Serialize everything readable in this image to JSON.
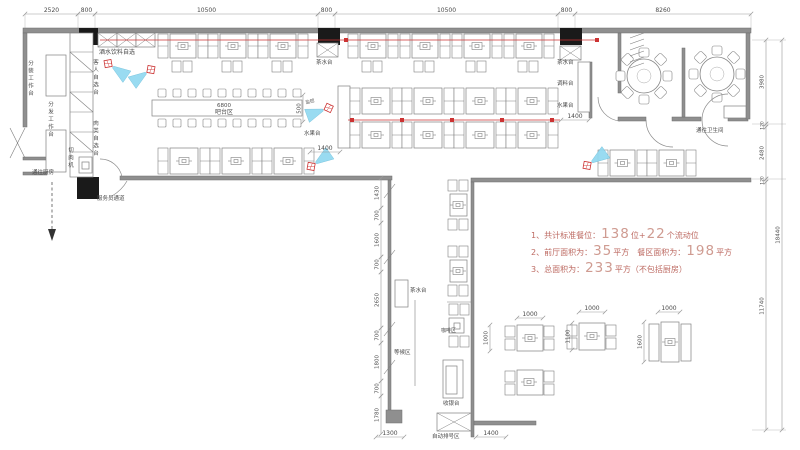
{
  "notes": {
    "line1": {
      "pre": "1、共计标准餐位：",
      "n1": "138",
      "mid": "位+",
      "n2": "22",
      "suf": "个流动位"
    },
    "line2": {
      "pre": "2、前厅面积为：",
      "n1": "35",
      "mid": "平方　餐区面积为：",
      "n2": "198",
      "suf": "平方"
    },
    "line3": {
      "pre": "3、总面积为：",
      "n1": "233",
      "suf": "平方（不包括厨房）"
    }
  },
  "plan": {
    "colors": {
      "wall": "#8f8f8f",
      "line": "#808080",
      "dim": "#999999",
      "dimtext": "#7a7a7a",
      "red": "#cc3333",
      "camera": "#8fd8f0",
      "black": "#1a1a1a"
    },
    "texts": [
      {
        "n": "label-drinks-self-service",
        "t": "酒水饮料自选",
        "x": 99,
        "y": 54,
        "s": 6
      },
      {
        "n": "label-packing-station",
        "t": "分装工作台",
        "x": 30,
        "y": 60,
        "s": 5.5,
        "v": 1
      },
      {
        "n": "label-distribution-station",
        "t": "分发工作台",
        "x": 50,
        "y": 101,
        "s": 5.5,
        "v": 1
      },
      {
        "n": "label-guest-self-select",
        "t": "客人自选台",
        "x": 95,
        "y": 59,
        "s": 5.5,
        "v": 1
      },
      {
        "n": "label-meat-self-select",
        "t": "肉类自选台",
        "x": 95,
        "y": 120,
        "s": 5.5,
        "v": 1
      },
      {
        "n": "label-meat-slicer",
        "t": "切肉机",
        "x": 70,
        "y": 147,
        "s": 5.5,
        "v": 1
      },
      {
        "n": "label-to-kitchen",
        "t": "通往厨房",
        "x": 32,
        "y": 174,
        "s": 5.5
      },
      {
        "n": "label-staff-passage",
        "t": "服务员通道",
        "x": 97,
        "y": 200,
        "s": 5.5
      },
      {
        "n": "label-bar-length",
        "t": "6800",
        "x": 224,
        "y": 107,
        "s": 5.5,
        "a": "m",
        "c": "#777777"
      },
      {
        "n": "label-bar-area",
        "t": "吧台区",
        "x": 224,
        "y": 114,
        "s": 6,
        "a": "m"
      },
      {
        "n": "label-tea-station-1",
        "t": "茶水台",
        "x": 316,
        "y": 64,
        "s": 5.5
      },
      {
        "n": "label-cctv",
        "t": "监控",
        "x": 306,
        "y": 104,
        "s": 4.5,
        "c": "#cc4444",
        "r": -15
      },
      {
        "n": "label-fruit-station-1",
        "t": "水果台",
        "x": 304,
        "y": 135,
        "s": 5.5
      },
      {
        "n": "label-tea-station-2",
        "t": "茶水台",
        "x": 557,
        "y": 64,
        "s": 5.5
      },
      {
        "n": "label-condiment-station",
        "t": "调料台",
        "x": 557,
        "y": 85,
        "s": 5.5
      },
      {
        "n": "label-fruit-station-2",
        "t": "水果台",
        "x": 557,
        "y": 107,
        "s": 5.5
      },
      {
        "n": "label-to-restroom",
        "t": "通往卫生间",
        "x": 696,
        "y": 132,
        "s": 5.5
      },
      {
        "n": "label-tea-station-3",
        "t": "茶水台",
        "x": 410,
        "y": 292,
        "s": 5.5
      },
      {
        "n": "label-waiting-area",
        "t": "等候区",
        "x": 394,
        "y": 354,
        "s": 5.5
      },
      {
        "n": "label-coffee-area",
        "t": "咖啡区",
        "x": 441,
        "y": 332,
        "s": 5
      },
      {
        "n": "label-cashier",
        "t": "收银台",
        "x": 443,
        "y": 405,
        "s": 5.5
      },
      {
        "n": "label-queue-number-area",
        "t": "自动排号区",
        "x": 432,
        "y": 438,
        "s": 5.5
      }
    ],
    "dims_h": [
      {
        "x1": 25,
        "x2": 78,
        "y": 14,
        "t": "2520"
      },
      {
        "x1": 78,
        "x2": 95,
        "y": 14,
        "t": "800"
      },
      {
        "x1": 95,
        "x2": 318,
        "y": 14,
        "t": "10500"
      },
      {
        "x1": 318,
        "x2": 335,
        "y": 14,
        "t": "800"
      },
      {
        "x1": 335,
        "x2": 558,
        "y": 14,
        "t": "10500"
      },
      {
        "x1": 558,
        "x2": 575,
        "y": 14,
        "t": "800"
      },
      {
        "x1": 575,
        "x2": 751,
        "y": 14,
        "t": "8260"
      },
      {
        "x1": 310,
        "x2": 340,
        "y": 152,
        "t": "1400"
      },
      {
        "x1": 561,
        "x2": 589,
        "y": 120,
        "t": "1400"
      },
      {
        "x1": 476,
        "x2": 506,
        "y": 437,
        "t": "1400"
      },
      {
        "x1": 376,
        "x2": 404,
        "y": 437,
        "t": "1300"
      },
      {
        "x1": 517,
        "x2": 543,
        "y": 318,
        "t": "1000"
      },
      {
        "x1": 579,
        "x2": 605,
        "y": 312,
        "t": "1000"
      },
      {
        "x1": 658,
        "x2": 680,
        "y": 312,
        "t": "1000"
      }
    ],
    "dims_v": [
      {
        "x": 766,
        "y1": 40,
        "y2": 124,
        "t": "3980"
      },
      {
        "x": 766,
        "y1": 124,
        "y2": 127,
        "t": "120"
      },
      {
        "x": 766,
        "y1": 127,
        "y2": 179,
        "t": "2480"
      },
      {
        "x": 766,
        "y1": 179,
        "y2": 182,
        "t": "120"
      },
      {
        "x": 766,
        "y1": 182,
        "y2": 430,
        "t": "11740"
      },
      {
        "x": 782,
        "y1": 40,
        "y2": 430,
        "t": "18440"
      },
      {
        "x": 381,
        "y1": 178,
        "y2": 208,
        "t": "1430"
      },
      {
        "x": 381,
        "y1": 208,
        "y2": 223,
        "t": "700"
      },
      {
        "x": 381,
        "y1": 223,
        "y2": 257,
        "t": "1600"
      },
      {
        "x": 381,
        "y1": 257,
        "y2": 272,
        "t": "700"
      },
      {
        "x": 381,
        "y1": 272,
        "y2": 328,
        "t": "2650"
      },
      {
        "x": 381,
        "y1": 328,
        "y2": 343,
        "t": "700"
      },
      {
        "x": 381,
        "y1": 343,
        "y2": 381,
        "t": "1800"
      },
      {
        "x": 381,
        "y1": 381,
        "y2": 396,
        "t": "700"
      },
      {
        "x": 381,
        "y1": 396,
        "y2": 434,
        "t": "1780"
      },
      {
        "x": 303,
        "y1": 95,
        "y2": 122,
        "t": "500"
      },
      {
        "x": 490,
        "y1": 325,
        "y2": 351,
        "t": "1000"
      },
      {
        "x": 572,
        "y1": 323,
        "y2": 350,
        "t": "1100"
      },
      {
        "x": 644,
        "y1": 322,
        "y2": 362,
        "t": "1600"
      }
    ],
    "walls": [
      [
        23,
        28,
        728,
        5
      ],
      [
        23,
        33,
        4,
        94
      ],
      [
        23,
        157,
        24,
        3
      ],
      [
        23,
        172,
        24,
        3
      ],
      [
        120,
        176,
        272,
        4
      ],
      [
        388,
        180,
        3,
        231
      ],
      [
        386,
        410,
        16,
        13
      ],
      [
        471,
        178,
        280,
        4
      ],
      [
        471,
        182,
        3,
        255
      ],
      [
        474,
        421,
        62,
        4
      ],
      [
        618,
        33,
        3,
        60
      ],
      [
        618,
        117,
        28,
        4
      ],
      [
        672,
        117,
        29,
        4
      ],
      [
        728,
        117,
        20,
        4
      ],
      [
        682,
        48,
        3,
        69
      ],
      [
        746,
        33,
        4,
        86
      ],
      [
        589,
        62,
        3,
        56
      ]
    ],
    "columns": [
      [
        79,
        28,
        19,
        17
      ],
      [
        318,
        28,
        22,
        17
      ],
      [
        560,
        28,
        22,
        17
      ],
      [
        77,
        177,
        22,
        22
      ]
    ],
    "rects": [
      [
        46,
        55,
        20,
        41
      ],
      [
        46,
        130,
        20,
        42
      ],
      [
        70,
        33,
        23,
        144
      ],
      [
        152,
        100,
        150,
        16
      ],
      [
        338,
        86,
        12,
        62
      ],
      [
        578,
        62,
        12,
        50
      ],
      [
        395,
        280,
        13,
        27
      ],
      [
        443,
        360,
        20,
        38
      ],
      [
        446,
        366,
        11,
        28
      ],
      [
        449,
        318,
        15,
        15
      ],
      [
        454,
        323,
        6,
        6
      ],
      [
        724,
        106,
        22,
        12
      ],
      [
        79,
        157,
        13,
        16
      ],
      [
        82,
        162,
        7,
        7
      ],
      [
        450,
        194,
        17,
        22
      ],
      [
        450,
        260,
        17,
        22
      ],
      [
        517,
        325,
        26,
        26
      ],
      [
        579,
        323,
        26,
        27
      ],
      [
        661,
        322,
        18,
        40
      ],
      [
        649,
        324,
        10,
        37
      ],
      [
        681,
        324,
        10,
        37
      ],
      [
        517,
        370,
        26,
        25
      ]
    ],
    "xrects": [
      [
        98,
        33,
        19,
        14
      ],
      [
        117,
        33,
        19,
        14
      ],
      [
        136,
        33,
        19,
        14
      ],
      [
        317,
        43,
        21,
        14
      ],
      [
        560,
        46,
        21,
        14
      ],
      [
        437,
        413,
        34,
        18
      ]
    ],
    "lines": [
      [
        70,
        52,
        93,
        52
      ],
      [
        70,
        72,
        93,
        72
      ],
      [
        70,
        92,
        93,
        92
      ],
      [
        70,
        112,
        93,
        112
      ],
      [
        70,
        132,
        93,
        132
      ],
      [
        70,
        152,
        93,
        152
      ],
      [
        70,
        52,
        93,
        72
      ],
      [
        70,
        92,
        93,
        112
      ],
      [
        70,
        132,
        93,
        152
      ],
      [
        10,
        128,
        25,
        158
      ],
      [
        25,
        128,
        10,
        158
      ],
      [
        384,
        198,
        395,
        184
      ],
      [
        384,
        264,
        395,
        250
      ],
      [
        384,
        336,
        395,
        322
      ],
      [
        384,
        374,
        395,
        360
      ],
      [
        415,
        300,
        415,
        386
      ],
      [
        447,
        302,
        471,
        302
      ],
      [
        630,
        38,
        644,
        33
      ],
      [
        630,
        44,
        644,
        39
      ],
      [
        630,
        50,
        644,
        45
      ],
      [
        630,
        56,
        644,
        51
      ],
      [
        630,
        62,
        644,
        57
      ],
      [
        630,
        68,
        644,
        63
      ]
    ],
    "ext_lines": [
      [
        25,
        14,
        25,
        30
      ],
      [
        78,
        14,
        78,
        30
      ],
      [
        95,
        14,
        95,
        30
      ],
      [
        318,
        14,
        318,
        30
      ],
      [
        335,
        14,
        335,
        30
      ],
      [
        558,
        14,
        558,
        30
      ],
      [
        575,
        14,
        575,
        30
      ],
      [
        751,
        14,
        751,
        30
      ],
      [
        752,
        40,
        786,
        40
      ],
      [
        752,
        124,
        786,
        124
      ],
      [
        752,
        179,
        786,
        179
      ],
      [
        752,
        430,
        786,
        430
      ]
    ],
    "booths": [
      [
        158,
        34,
        50,
        24
      ],
      [
        208,
        34,
        50,
        24
      ],
      [
        258,
        34,
        50,
        24
      ],
      [
        348,
        34,
        50,
        24
      ],
      [
        400,
        34,
        50,
        24
      ],
      [
        452,
        34,
        50,
        24
      ],
      [
        504,
        34,
        50,
        24
      ],
      [
        350,
        88,
        52,
        26
      ],
      [
        402,
        88,
        52,
        26
      ],
      [
        454,
        88,
        52,
        26
      ],
      [
        506,
        88,
        52,
        26
      ],
      [
        350,
        122,
        52,
        26
      ],
      [
        402,
        122,
        52,
        26
      ],
      [
        454,
        122,
        52,
        26
      ],
      [
        506,
        122,
        52,
        26
      ],
      [
        158,
        148,
        52,
        26
      ],
      [
        210,
        148,
        52,
        26
      ],
      [
        262,
        148,
        52,
        26
      ],
      [
        598,
        150,
        49,
        26
      ],
      [
        647,
        150,
        49,
        26
      ]
    ],
    "cookers": [
      [
        458,
        205
      ],
      [
        458,
        271
      ],
      [
        530,
        338
      ],
      [
        592,
        336
      ],
      [
        670,
        342
      ],
      [
        529,
        382
      ]
    ],
    "chairs2h": [
      [
        172,
        61
      ],
      [
        222,
        61
      ],
      [
        272,
        61
      ],
      [
        362,
        61
      ],
      [
        414,
        61
      ],
      [
        466,
        61
      ],
      [
        518,
        61
      ],
      [
        448,
        180
      ],
      [
        448,
        219
      ],
      [
        448,
        246
      ],
      [
        448,
        285
      ],
      [
        449,
        304
      ],
      [
        449,
        336
      ]
    ],
    "chairs2v": [
      [
        505,
        326
      ],
      [
        544,
        326
      ],
      [
        567,
        325
      ],
      [
        606,
        325
      ],
      [
        505,
        371
      ],
      [
        544,
        371
      ]
    ],
    "stool_rows": [
      {
        "x": 158,
        "y": 89,
        "n": 10,
        "s": 15
      },
      {
        "x": 158,
        "y": 119,
        "n": 10,
        "s": 15
      }
    ],
    "round_tables": [
      {
        "cx": 644,
        "cy": 76,
        "r": 17
      },
      {
        "cx": 717,
        "cy": 74,
        "r": 17
      }
    ],
    "cameras": [
      {
        "x": 113,
        "y": 67,
        "a": 35
      },
      {
        "x": 146,
        "y": 73,
        "a": 145
      },
      {
        "x": 323,
        "y": 110,
        "a": 160
      },
      {
        "x": 316,
        "y": 163,
        "a": -35
      },
      {
        "x": 592,
        "y": 162,
        "a": -35
      }
    ],
    "red_lines": [
      {
        "x1": 100,
        "y1": 40,
        "x2": 597,
        "y2": 40,
        "marks": [
          346,
          597
        ]
      },
      {
        "x1": 348,
        "y1": 120,
        "x2": 560,
        "y2": 120,
        "marks": [
          352,
          402,
          452,
          502,
          552
        ]
      }
    ],
    "arcs": [
      "M122,177 A22,22 0 0 0 100,159",
      "M598,97 A24,24 0 0 0 620,121",
      "M646,120 A27,27 0 0 0 673,147",
      "M702,120 A26,26 0 0 0 728,146",
      "M728,94 A26,26 0 0 0 702,120",
      "M112,196 Q122,190 127,181"
    ],
    "dashed_arrow": {
      "x": 52,
      "y1": 182,
      "y2": 229,
      "head": "48,229 56,229 52,241"
    }
  }
}
